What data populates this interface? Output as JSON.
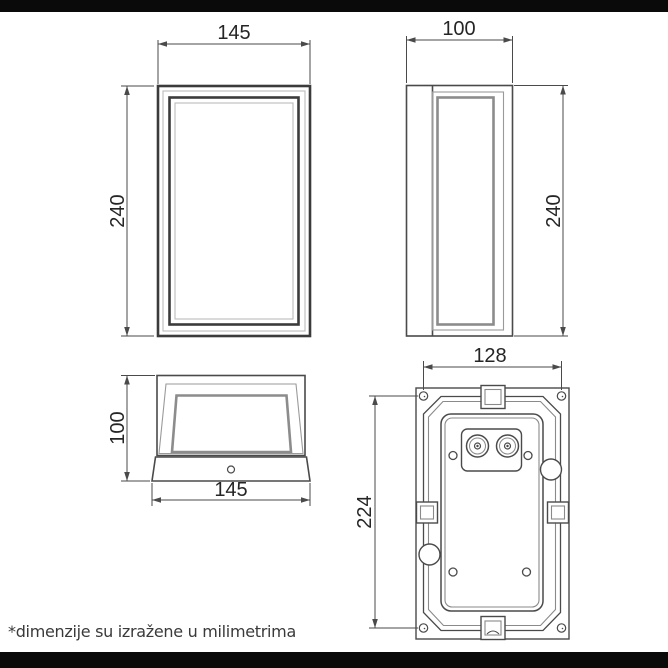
{
  "page": {
    "background": "#ffffff",
    "top_bar_color": "#0a0a0a",
    "bottom_bar_color": "#0a0a0a",
    "line_color": "#4a4a4a",
    "heavy_line_color": "#3b3b3b",
    "light_line_color": "#b5b5b5",
    "glass_frame_color": "#8c8c8c",
    "dim_text_color": "#252525"
  },
  "footnote": {
    "text": "*dimenzije su izražene u milimetrima"
  },
  "views": {
    "front": {
      "width": "145",
      "height": "240"
    },
    "side": {
      "depth": "100",
      "height": "240"
    },
    "top": {
      "depth": "100",
      "width": "145"
    },
    "back": {
      "hole_spacing_width": "128",
      "hole_spacing_height": "224"
    }
  }
}
